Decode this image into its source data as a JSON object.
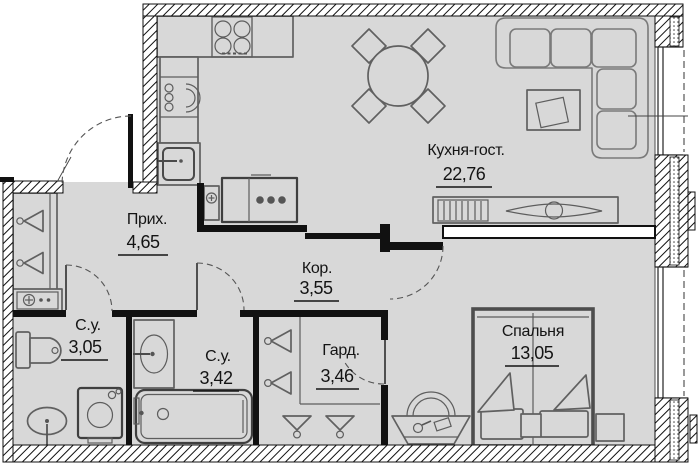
{
  "plan": {
    "type": "apartment-floor-plan",
    "rooms": [
      {
        "id": "kitchen-living",
        "label": "Кухня-гост.",
        "area": "22,76"
      },
      {
        "id": "hallway",
        "label": "Прих.",
        "area": "4,65"
      },
      {
        "id": "corridor",
        "label": "Кор.",
        "area": "3,55"
      },
      {
        "id": "bathroom-1",
        "label": "С.у.",
        "area": "3,05"
      },
      {
        "id": "bathroom-2",
        "label": "С.у.",
        "area": "3,42"
      },
      {
        "id": "wardrobe",
        "label": "Гард.",
        "area": "3,46"
      },
      {
        "id": "bedroom",
        "label": "Спальня",
        "area": "13,05"
      }
    ]
  },
  "colors": {
    "floor": "#d8d8d8",
    "walls": "#111111",
    "furniture_outline": "#606060",
    "label_text": "#141414"
  }
}
